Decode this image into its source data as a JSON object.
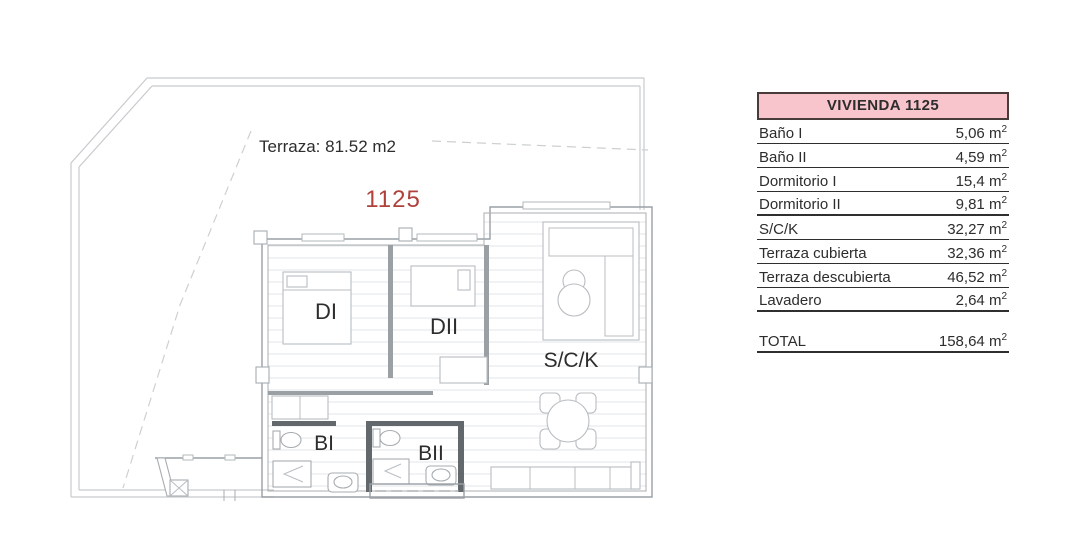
{
  "plan": {
    "terrace_label": "Terraza: 81.52 m2",
    "unit_number": "1125",
    "room_labels": {
      "dormitorio1": "DI",
      "dormitorio2": "DII",
      "salon_cocina": "S/C/K",
      "bano1": "BI",
      "bano2": "BII"
    },
    "colors": {
      "unit_number": "#b0423c",
      "drawing_line": "#9aa0a5",
      "label_text": "#2d2d2d"
    }
  },
  "table": {
    "title": "VIVIENDA 1125",
    "colors": {
      "header_bg": "#f9c5cc",
      "header_border": "#4a3b3b",
      "line": "#2f2f2f"
    },
    "unit": "m",
    "unit_exponent": "2",
    "rows": [
      {
        "label": "Baño I",
        "value": "5,06"
      },
      {
        "label": "Baño II",
        "value": "4,59"
      },
      {
        "label": "Dormitorio I",
        "value": "15,4"
      },
      {
        "label": "Dormitorio II",
        "value": "9,81"
      },
      {
        "label": "S/C/K",
        "value": "32,27"
      },
      {
        "label": "Terraza cubierta",
        "value": "32,36"
      },
      {
        "label": "Terraza descubierta",
        "value": "46,52"
      },
      {
        "label": "Lavadero",
        "value": "2,64"
      }
    ],
    "total": {
      "label": "TOTAL",
      "value": "158,64"
    }
  }
}
